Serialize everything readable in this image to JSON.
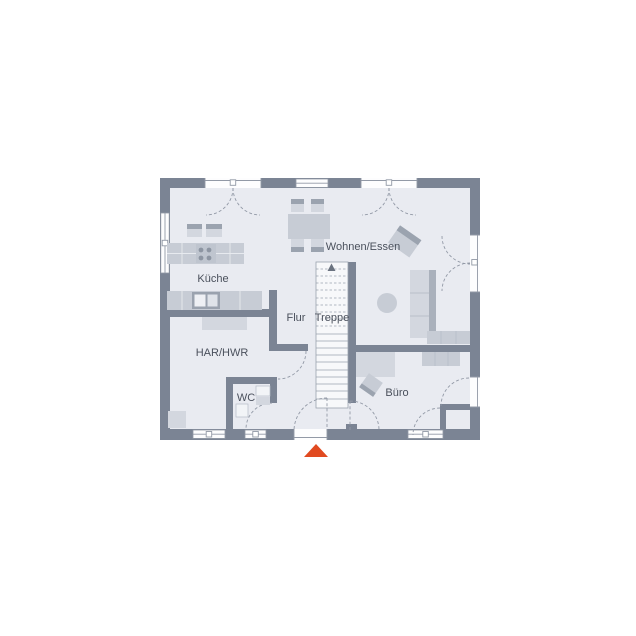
{
  "plan": {
    "rooms": [
      {
        "id": "kueche",
        "label": "Küche"
      },
      {
        "id": "wohnen-essen",
        "label": "Wohnen/Essen"
      },
      {
        "id": "flur",
        "label": "Flur"
      },
      {
        "id": "treppe",
        "label": "Treppe"
      },
      {
        "id": "har-hwr",
        "label": "HAR/HWR"
      },
      {
        "id": "wc",
        "label": "WC"
      },
      {
        "id": "buero",
        "label": "Büro"
      }
    ],
    "stairs": {
      "direction": "up"
    },
    "entrance_marker": "triangle-up"
  },
  "colors": {
    "background": "#ffffff",
    "wall": "#7b8494",
    "floor": "#e9ebf1",
    "opening": "#fdfdfe",
    "furniture_light": "#d3d7df",
    "furniture_medium": "#c7ccd5",
    "accent_dark": "#9ba3af",
    "line": "#9299a6",
    "text": "#4a505c",
    "entrance": "#e14a20"
  }
}
